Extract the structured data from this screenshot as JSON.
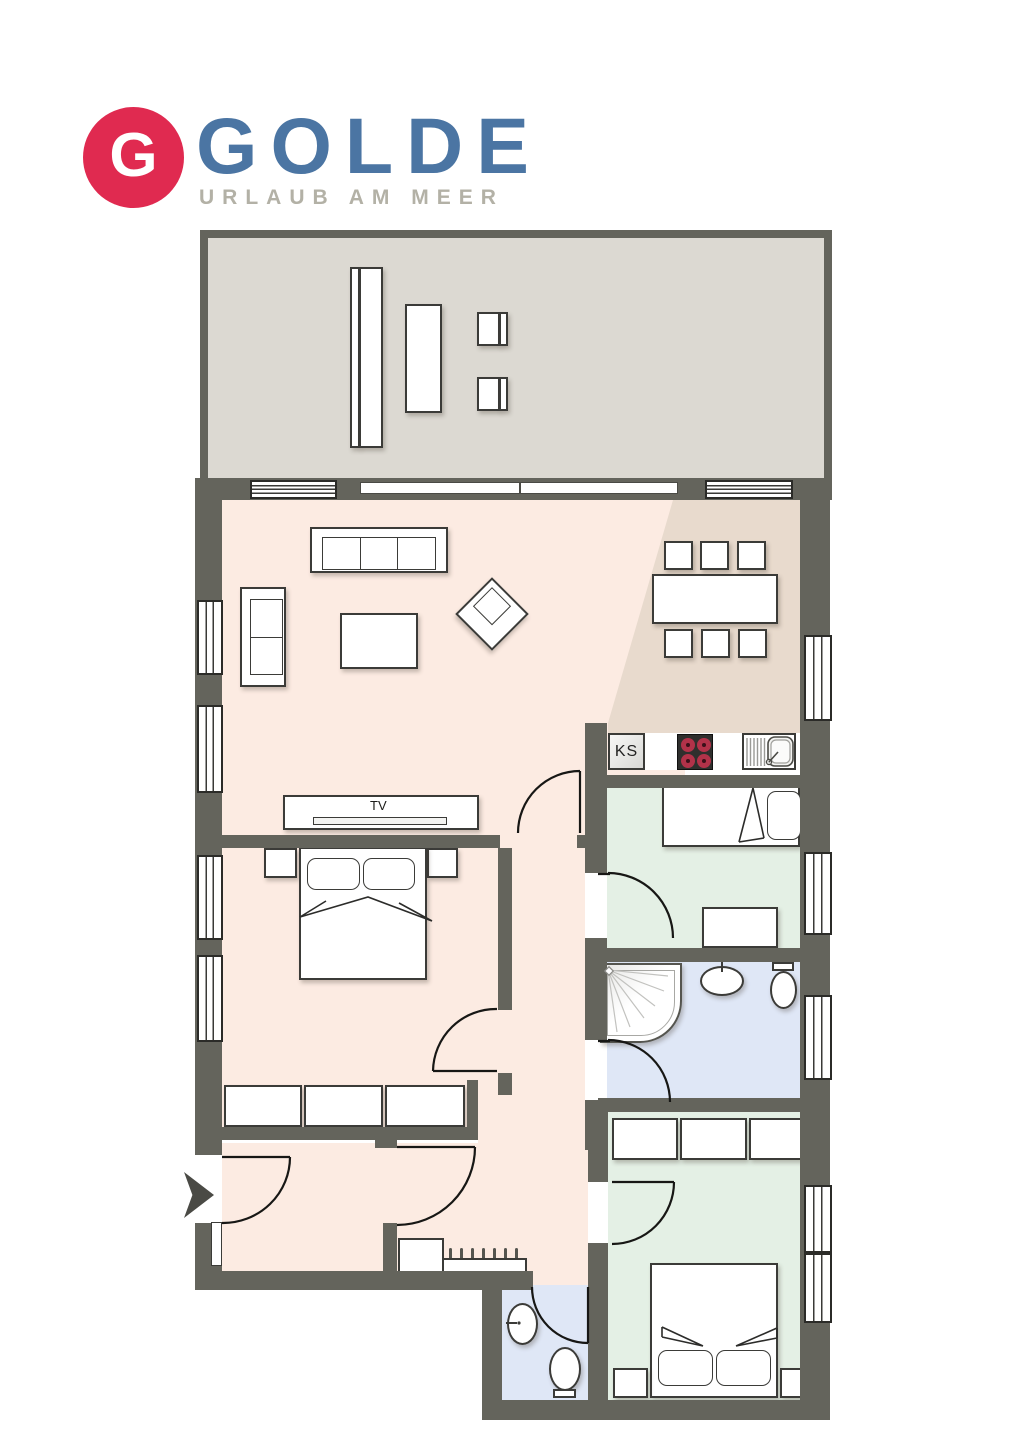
{
  "logo": {
    "monogram": "G",
    "brand": "GOLDE",
    "tagline": "URLAUB AM MEER"
  },
  "labels": {
    "tv": "TV",
    "ks": "KS"
  },
  "colors": {
    "wall": "#64645c",
    "terrace": "#dcd9d2",
    "living": "#fcebe2",
    "dining": "#e8dacd",
    "bedroom": "#e4f0e5",
    "bath": "#dfe7f6",
    "burner": "#b23249",
    "logo_red": "#e02a50",
    "logo_blue": "#4b75a3",
    "logo_gray": "#b3b1a6"
  }
}
